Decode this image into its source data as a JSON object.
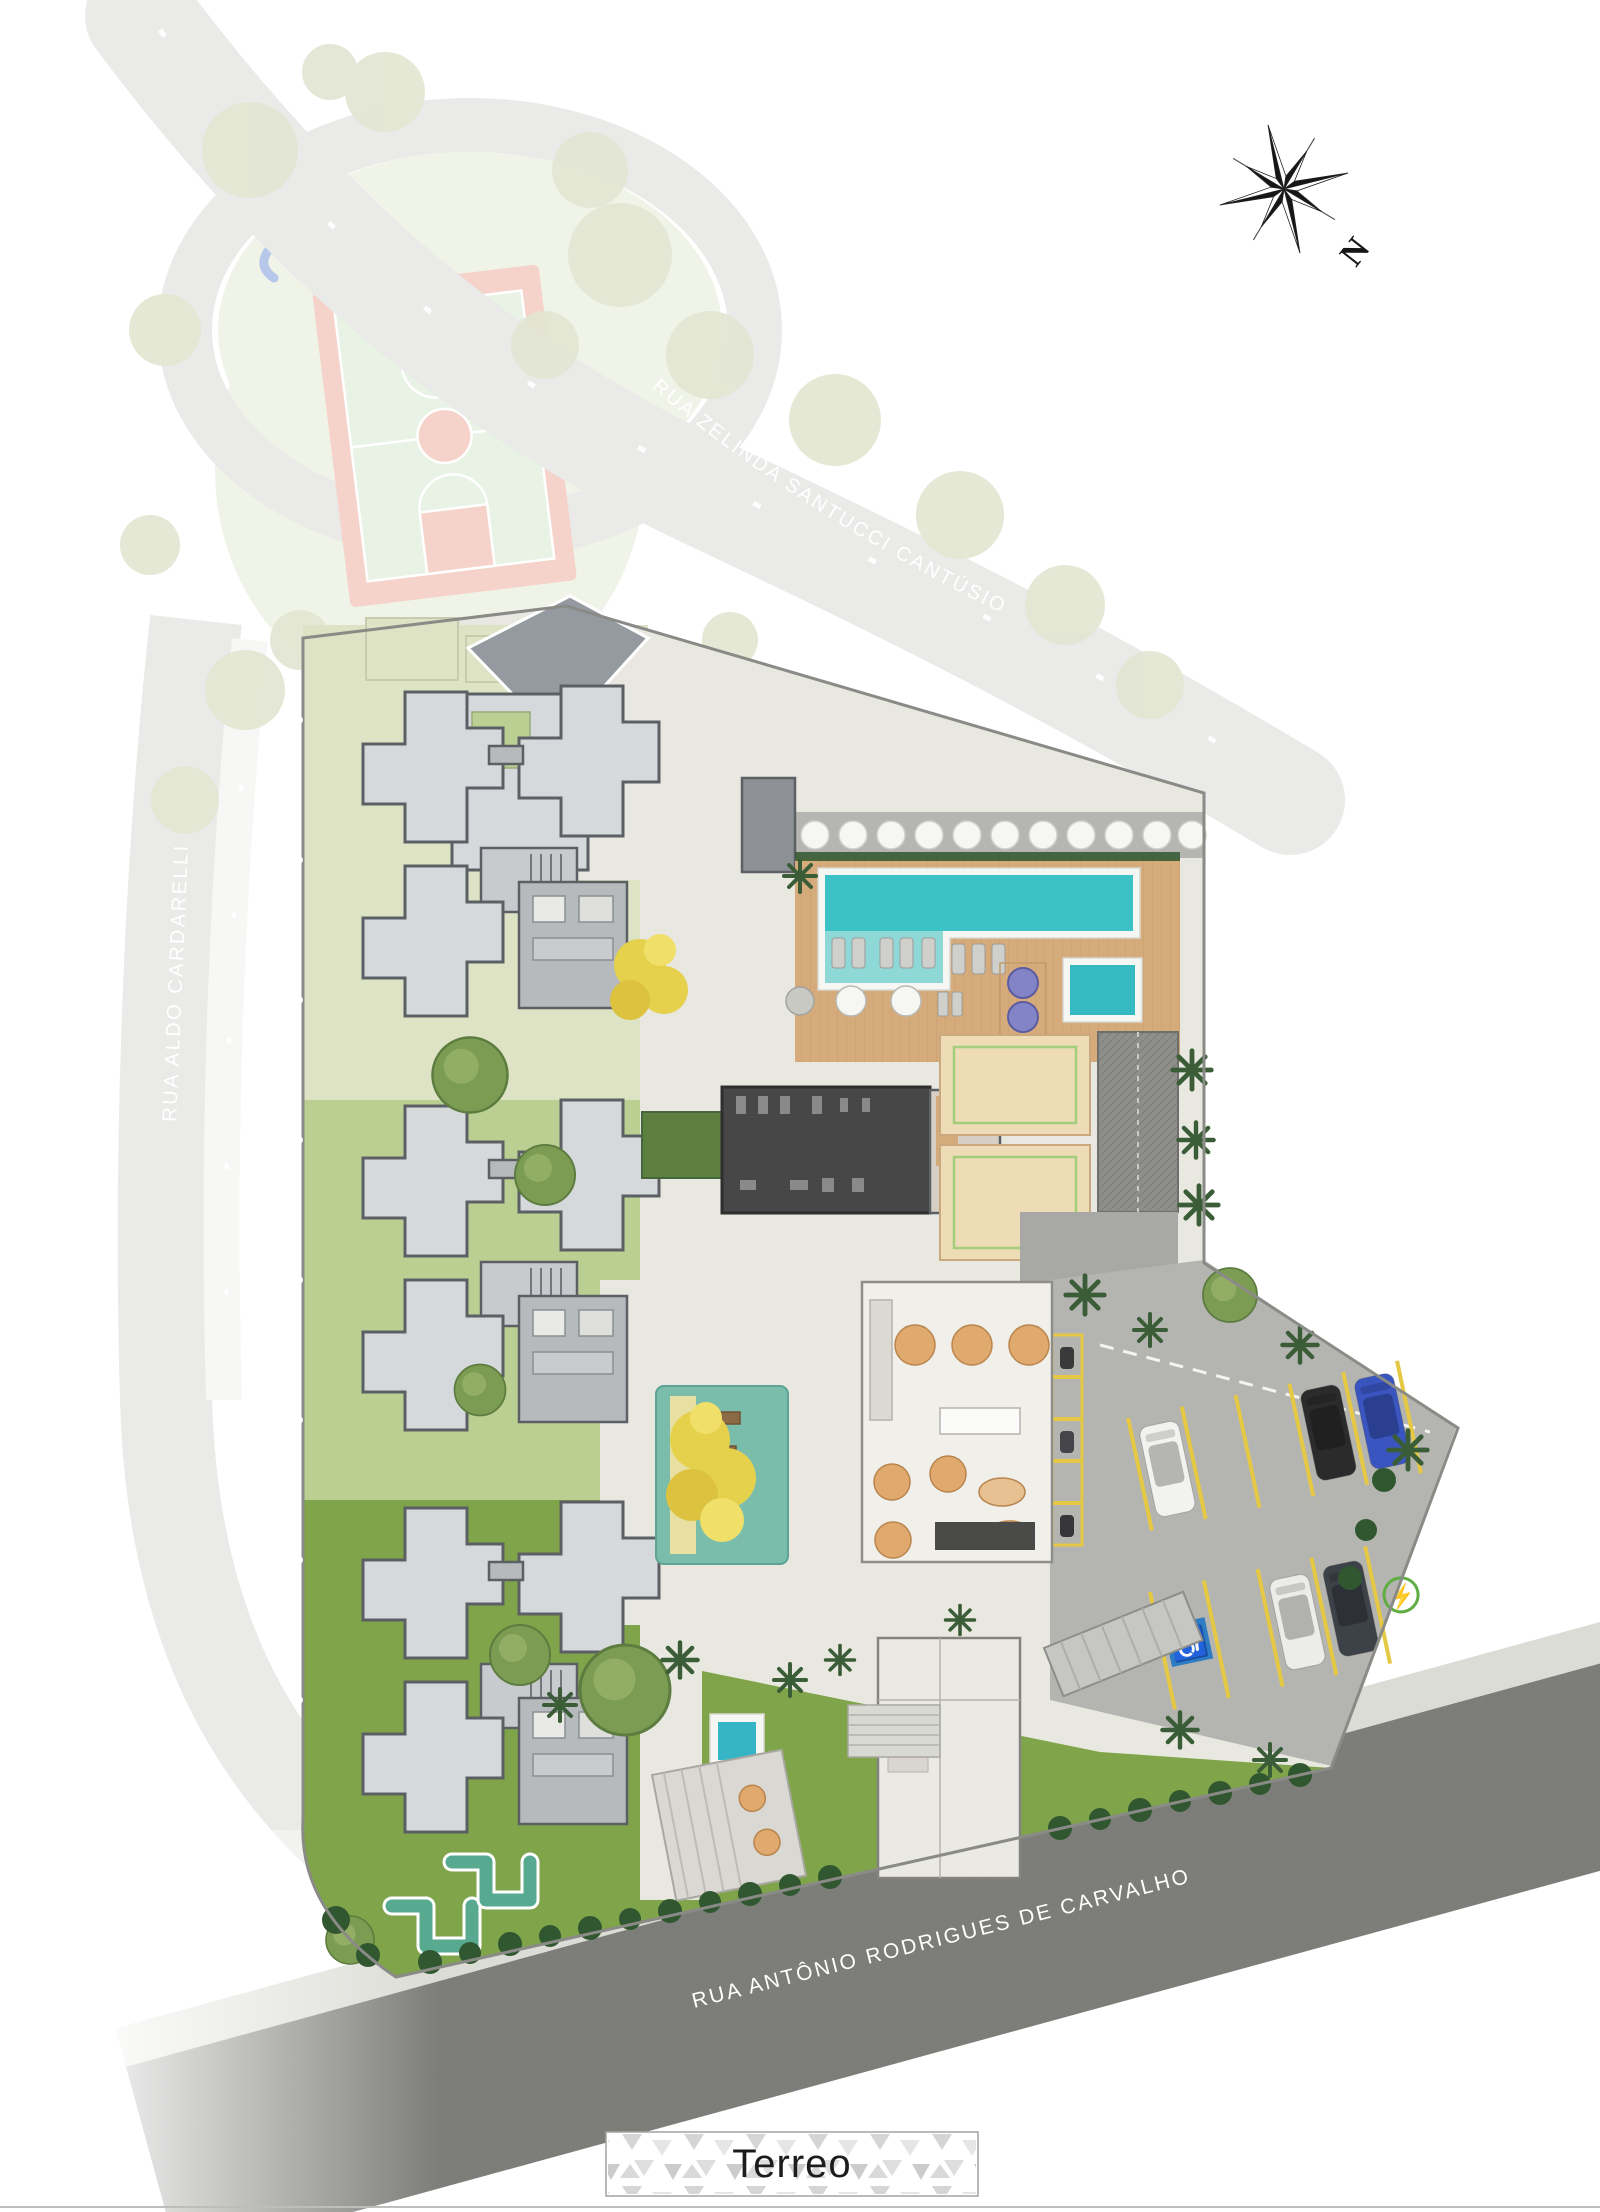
{
  "plan": {
    "floor_label": "Terreo"
  },
  "compass": {
    "north_letter": "N"
  },
  "streets": {
    "curved_top": "RUA ZELINDA SANTUCCI CANTÚSIO",
    "left_vertical": "RUA ALDO CARDARELLI",
    "bottom_diagonal": "RUA ANTÔNIO RODRIGUES DE CARVALHO"
  },
  "icons": {
    "compass_rose": "compass-rose-icon",
    "accessible_parking_glyph": "♿",
    "ev_charging_glyph": "⚡"
  },
  "colors": {
    "page_bg": "#ffffff",
    "street_text": "#ffffff",
    "road_light": "#d4d4d1",
    "road_dark": "#7d7d7a",
    "sidewalk": "#dcdcd6",
    "site_pavement": "#e8e8e1",
    "lawn_pale": "#dde3c4",
    "lawn_mid": "#bccf92",
    "lawn_vivid": "#7fa449",
    "park_lawn": "#e0e6d0",
    "court_red": "#eca795",
    "court_green": "#d2e6ca",
    "building_fill": "#d6d9dc",
    "building_stroke": "#5c6064",
    "annex_fill": "#b6babd",
    "core_fill": "#c8cbce",
    "gym_fill": "#474747",
    "gym_equip": "#8a8a8a",
    "deck_wood": "#d6ab7c",
    "pool_water": "#3cc2c4",
    "pool_shelf": "#8fd8d8",
    "pool_rim": "#f6f6f2",
    "kids_pool": "#35bac1",
    "spa_purple": "#8384c8",
    "sand": "#eddcb6",
    "sand_line": "#a4cd7c",
    "ramp": "#8e8e8b",
    "parking_concrete": "#b4b4b0",
    "parking_stripe": "#e5c844",
    "accessible_blue": "#2e7cc4",
    "ev_green": "#5fae43",
    "hedge_green": "#30572f",
    "tree_green": "#7d9c53",
    "tree_dark": "#5d7c40",
    "tree_olive": "#c6cda6",
    "palm_dark": "#3a5c37",
    "ipe_yellow": "#e6d14d",
    "playground_teal": "#7abdab",
    "playground_path": "#e8e0a2",
    "compass_black": "#161616",
    "label_border": "#a3a3a3",
    "label_text": "#1c1c1c",
    "label_mosaic": "#d0d0d0"
  }
}
